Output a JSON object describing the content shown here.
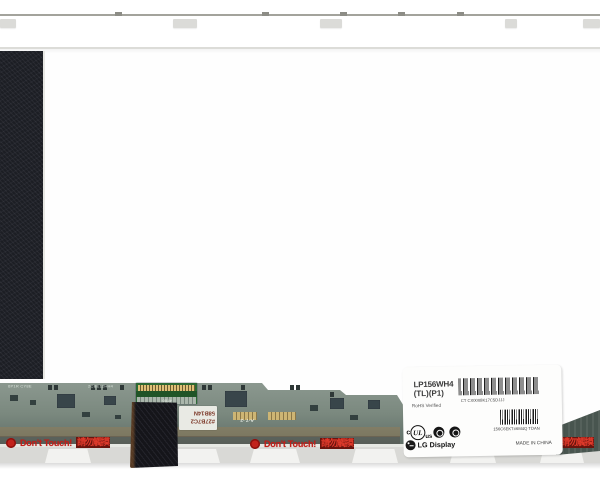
{
  "photo": {
    "description": "Rear-view product photo of a 15.6-inch laptop LCD screen panel with bottom driver PCB, warning stickers and manufacturer spec label"
  },
  "pcb": {
    "silkscreen_1": "6P1R CY8E",
    "silkscreen_2": "2CBE12HH4",
    "connector_code": "4T00",
    "sticker_code_line1": "#27B7C2",
    "sticker_code_line2": "58B14N",
    "stencil_code": "A-7 -2",
    "warning": {
      "en": "Don't Touch!",
      "zh": "請勿觸摸"
    }
  },
  "label": {
    "model": "LP156WH4",
    "variant": "(TL)(P1)",
    "rohs": "RoHS Verified",
    "barcode1_text": "CT CX0008K17C5DJJJ",
    "barcode2_text": "156C6EKT#6M4Q  TDAN",
    "cert_ul_c": "c",
    "cert_ul": "UL",
    "cert_ul_us": "us",
    "brand": "LG Display",
    "made_in": "MADE IN CHINA"
  },
  "colors": {
    "warning_red": "#c41e18",
    "pcb_green": "#7b897f",
    "tape_black": "#15151a",
    "label_white": "#fdfdfc"
  }
}
